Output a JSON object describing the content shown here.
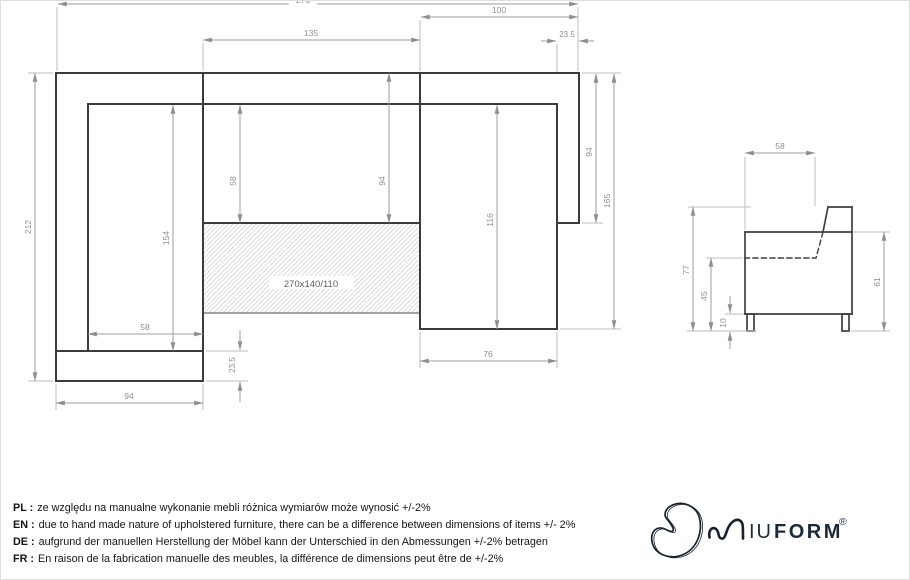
{
  "colors": {
    "outline": "#3b3b3b",
    "dimension_line": "#9c9c9c",
    "dimension_text": "#8f8f8f",
    "hatch_line": "#d7d7d7",
    "brand_navy": "#1b2a3a",
    "sheet_border": "#dedede"
  },
  "plan_view": {
    "dims": {
      "total_width": "270",
      "back_seat_width": "135",
      "chaise_section_width": "100",
      "right_arm_width": "23.5",
      "total_depth": "212",
      "left_inner_depth": "154",
      "seat_depth": "58",
      "seat_depth_with_back": "94",
      "left_seat_width": "58",
      "front_strip_depth": "23.5",
      "left_section_width": "94",
      "chaise_inner_length": "116",
      "chaise_seat_width": "76",
      "right_arm_length": "94",
      "right_total_length": "165"
    },
    "sleeping_area": "270x140/110"
  },
  "side_view": {
    "dims": {
      "seat_depth": "58",
      "total_height": "77",
      "seat_height": "45",
      "leg_height": "10",
      "armrest_height": "61"
    }
  },
  "disclaimer": {
    "items": [
      {
        "label": "PL :",
        "text": "ze względu na manualne wykonanie mebli różnica wymiarów może wynosić +/-2%"
      },
      {
        "label": "EN :",
        "text": "due to hand made nature of upholstered furniture, there can be a difference between dimensions of items +/- 2%"
      },
      {
        "label": "DE :",
        "text": "aufgrund der manuellen Herstellung der Möbel kann der Unterschied in den Abmessungen +/-2% betragen"
      },
      {
        "label": "FR :",
        "text": "En raison de la fabrication manuelle des meubles, la différence de dimensions peut être de +/-2%"
      }
    ]
  },
  "logo": {
    "word_light": "IU",
    "word_bold": "FORM",
    "registered": "®"
  }
}
